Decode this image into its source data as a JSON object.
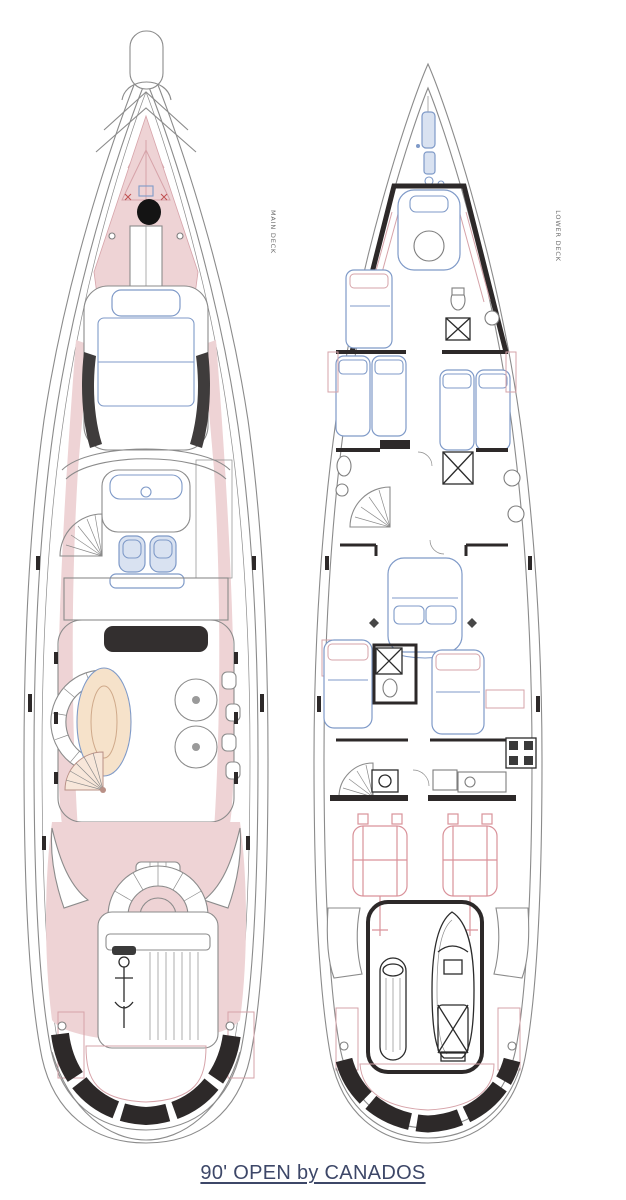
{
  "window": {
    "width": 626,
    "height": 1200,
    "background": "#ffffff"
  },
  "figure": {
    "type": "yacht-deck-plans",
    "plans": [
      {
        "id": "main-deck",
        "label": "MAIN DECK"
      },
      {
        "id": "lower-deck",
        "label": "LOWER DECK"
      }
    ],
    "caption": {
      "text": "90' OPEN by CANADOS"
    }
  },
  "colors": {
    "hull-line": "#8b8b8b",
    "wall-black": "#2d2929",
    "deck-pink": "#eed3d5",
    "deck-pink-line": "#d6a3a9",
    "furniture-blue": "#7f9ac8",
    "furniture-blue-fill": "#d9e2f1",
    "fixture-gray": "#7e7e7e",
    "table-peach": "#f6e2ca",
    "engine-pink": "#d9929a",
    "label-gray": "#6f6f6f",
    "caption-navy": "#3d4768",
    "floor-stripe": "#e2e2e2"
  }
}
